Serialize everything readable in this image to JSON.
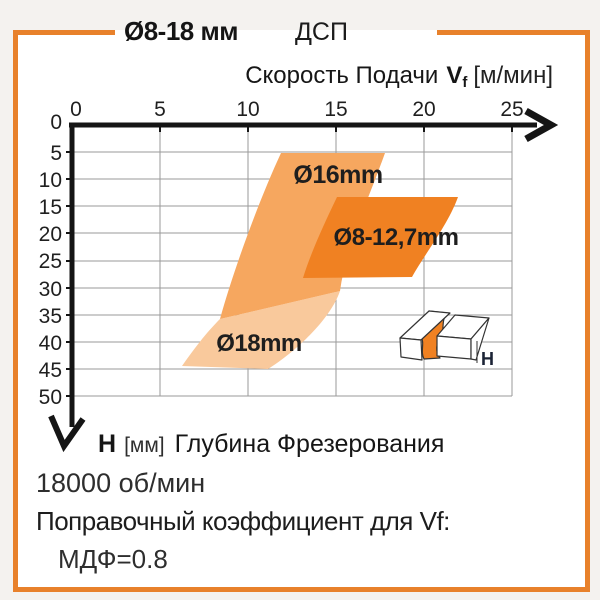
{
  "header": {
    "range_title": "Ø8-18 мм",
    "material": "ДСП"
  },
  "x_axis": {
    "title_prefix": "Скорость Подачи",
    "title_var": "V",
    "title_var_sub": "f",
    "title_unit": "[м/мин]",
    "ticks": [
      "0",
      "5",
      "10",
      "15",
      "20",
      "25"
    ]
  },
  "y_axis": {
    "var": "H",
    "unit": "[мм]",
    "title": "Глубина Фрезерования",
    "ticks": [
      "0",
      "5",
      "10",
      "15",
      "20",
      "25",
      "30",
      "35",
      "40",
      "45",
      "50"
    ]
  },
  "bands": {
    "d16_label": "Ø16mm",
    "d8_127_label": "Ø8-12,7mm",
    "d18_label": "Ø18mm"
  },
  "pictogram": {
    "depth_label": "H"
  },
  "footer": {
    "rpm": "18000 об/мин",
    "correction_title": "Поправочный коэффициент для Vf:",
    "correction_value": "МДФ=0.8"
  },
  "colors": {
    "frame": "#E8812B",
    "band_dark": "#F08122",
    "band_medium": "#F6A75F",
    "band_pale": "#F9C99C",
    "axis": "#151515",
    "grid": "#9A9A9A"
  },
  "chart_data": {
    "type": "area",
    "title": "Ø8-18 мм — ДСП",
    "xlabel": "Скорость Подачи Vf [м/мин]",
    "ylabel": "H [мм] Глубина Фрезерования",
    "xlim": [
      0,
      26
    ],
    "ylim": [
      0,
      50
    ],
    "y_inverted": true,
    "grid": true,
    "series": [
      {
        "name": "Ø16mm",
        "region_vertices_vf_h": [
          [
            12.0,
            5.0
          ],
          [
            17.8,
            5.0
          ],
          [
            15.2,
            30.6
          ],
          [
            8.4,
            35.8
          ]
        ]
      },
      {
        "name": "Ø8-12,7mm",
        "region_vertices_vf_h": [
          [
            15.1,
            13.3
          ],
          [
            21.9,
            13.3
          ],
          [
            19.3,
            28.0
          ],
          [
            13.1,
            28.2
          ]
        ]
      },
      {
        "name": "Ø18mm",
        "region_vertices_vf_h": [
          [
            8.4,
            35.8
          ],
          [
            15.2,
            30.6
          ],
          [
            11.1,
            45.0
          ],
          [
            6.3,
            44.5
          ]
        ]
      }
    ],
    "notes": [
      "18000 об/мин",
      "Поправочный коэффициент для Vf: МДФ=0.8"
    ]
  }
}
